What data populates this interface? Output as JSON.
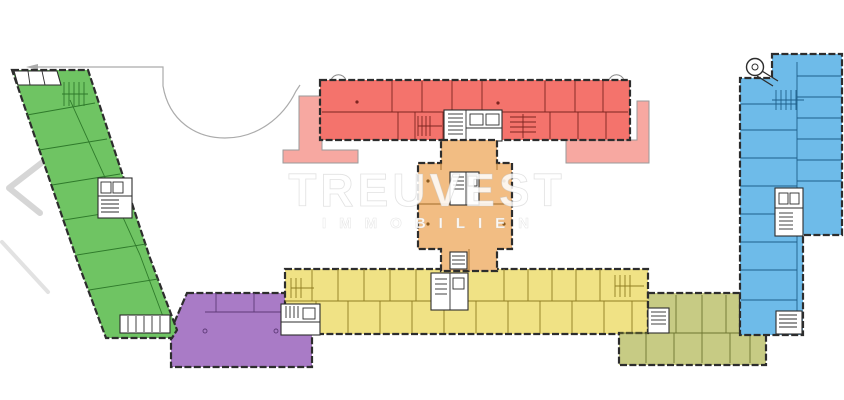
{
  "watermark": {
    "line1": "TREUVEST",
    "line2": "IMMOBILIEN"
  },
  "floorplan": {
    "background": "#ffffff",
    "outline_color": "#2d2d2d",
    "site_line_color": "#ababab",
    "terrace_color": "#f7a8a1",
    "sections": [
      {
        "name": "green-wing",
        "color": "#6fc463"
      },
      {
        "name": "red-wing",
        "color": "#f4736c"
      },
      {
        "name": "orange-core",
        "color": "#f2bd83"
      },
      {
        "name": "yellow-wing",
        "color": "#f0e285"
      },
      {
        "name": "purple-hall",
        "color": "#a97bc6"
      },
      {
        "name": "olive-wing",
        "color": "#c7cb84"
      },
      {
        "name": "blue-wing",
        "color": "#6ebbe9"
      }
    ]
  }
}
